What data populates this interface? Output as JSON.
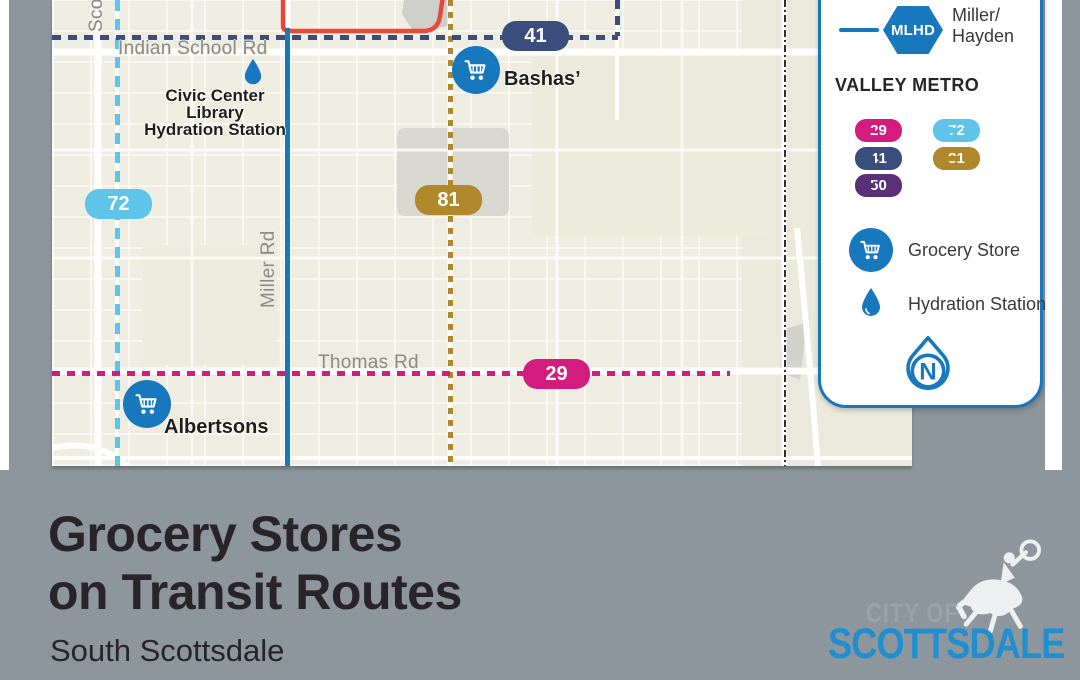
{
  "colors": {
    "brand_blue": "#1778BE",
    "route_29_pink": "#D31D7E",
    "route_72_light_blue": "#5EC4E9",
    "route_41_navy": "#3A4E7E",
    "route_81_gold": "#B1872B",
    "route_50_purple": "#5A3179",
    "red_route": "#E8483A",
    "map_background": "#EFEDE2",
    "page_gray": "#8D969D",
    "logo_blue": "#1E90D2"
  },
  "map": {
    "street_labels": {
      "indian_school": "Indian School Rd",
      "thomas": "Thomas Rd",
      "miller": "Miller Rd",
      "scottsdale": "Scottsdale Rd"
    },
    "route_badges": {
      "r41": "41",
      "r72": "72",
      "r81": "81",
      "r29": "29"
    },
    "pois": {
      "bashas": "Bashas’",
      "albertsons": "Albertsons",
      "hydration_line1": "Civic Center Library",
      "hydration_line2": "Hydration Station"
    }
  },
  "legend": {
    "mlhd_badge": "MLHD",
    "mlhd_line1": "Miller/",
    "mlhd_line2": "Hayden",
    "heading": "VALLEY METRO",
    "routes": [
      {
        "number": "29",
        "color": "#D31D7E"
      },
      {
        "number": "72",
        "color": "#5EC4E9"
      },
      {
        "number": "41",
        "color": "#3A4E7E"
      },
      {
        "number": "81",
        "color": "#B1872B"
      },
      {
        "number": "50",
        "color": "#5A3179"
      }
    ],
    "grocery_label": "Grocery Store",
    "hydration_label": "Hydration Station",
    "north_letter": "N"
  },
  "footer": {
    "title_line1": "Grocery Stores",
    "title_line2": "on Transit Routes",
    "subtitle": "South Scottsdale",
    "logo_city_of": "CITY OF",
    "logo_name": "SCOTTSDALE"
  }
}
